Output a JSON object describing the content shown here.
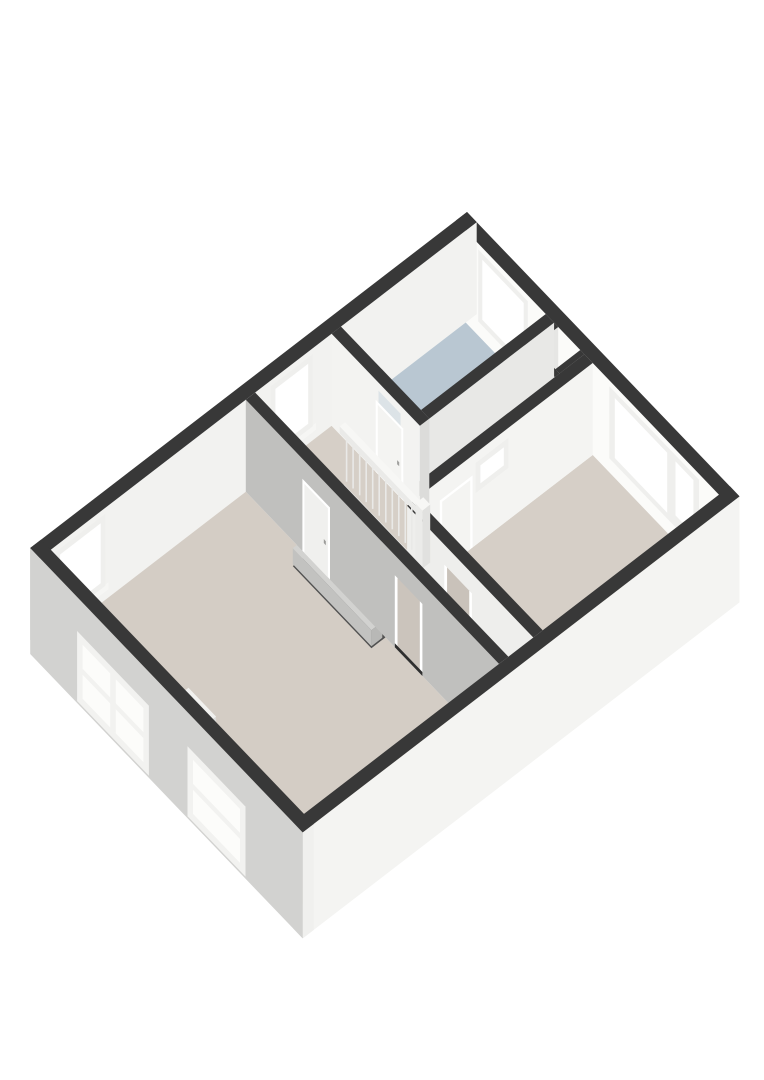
{
  "meta": {
    "description": "3D isometric floor plan render of an upper floor with landing, stairwell, bathroom and two bedrooms",
    "view": "axonometric"
  },
  "colors": {
    "wall_cut_top": "#383838",
    "wall_white": "#f4f4f2",
    "wall_gray": "#c0c0be",
    "facade_sw": "#d2d2d0",
    "facade_se": "#f4f4f2",
    "floor_beige": "#d6cfc7",
    "floor_bathroom": "#b9c7d2",
    "stair_void": "#515151",
    "threshold_dark": "#2f2f2f",
    "sink_wood": "#cdbfa8",
    "glass_white": "#ffffff",
    "transom_glass": "#dce3e7"
  },
  "rooms": [
    {
      "name": "bathroom",
      "floor_color": "#b9c7d2"
    },
    {
      "name": "landing-hall",
      "floor_color": "#d6cfc7"
    },
    {
      "name": "bedroom-right",
      "floor_color": "#d6cfc7"
    },
    {
      "name": "bedroom-left",
      "floor_color": "#d4cdc5"
    },
    {
      "name": "corridor-strip",
      "floor_color": "#d3ccc4"
    },
    {
      "name": "shaft-niche",
      "floor_color": "#7a7e80"
    }
  ],
  "scene": [
    {
      "t": "box",
      "name": "facade-ne-wall",
      "r": [
        0,
        0,
        395,
        14
      ],
      "z": [
        0,
        92
      ],
      "c": {
        "top": "#383838",
        "sw": "#fbfbf9",
        "se": "#efefed"
      }
    },
    {
      "t": "qsw",
      "name": "bathroom-window-frame",
      "v": 14,
      "u": [
        32,
        104
      ],
      "z": [
        14,
        86
      ],
      "fill": "#efefed"
    },
    {
      "t": "qsw",
      "name": "bathroom-window-glass",
      "v": 14,
      "u": [
        38,
        98
      ],
      "z": [
        20,
        80
      ],
      "fill": "#ffffff"
    },
    {
      "t": "qsw",
      "name": "bedroom-window-frame",
      "v": 14,
      "u": [
        222,
        352
      ],
      "z": [
        14,
        86
      ],
      "fill": "#efefed"
    },
    {
      "t": "qsw",
      "name": "bedroom-window-glass-large",
      "v": 14,
      "u": [
        230,
        306
      ],
      "z": [
        20,
        80
      ],
      "fill": "#ffffff"
    },
    {
      "t": "qsw",
      "name": "bedroom-window-glass-small",
      "v": 14,
      "u": [
        318,
        344
      ],
      "z": [
        26,
        80
      ],
      "fill": "#ffffff"
    },
    {
      "t": "box",
      "name": "facade-nw-wall",
      "r": [
        0,
        0,
        14,
        560
      ],
      "z": [
        0,
        92
      ],
      "c": {
        "top": "#383838",
        "sw": "#cfcfcd",
        "se": "#f2f2f0"
      }
    },
    {
      "t": "qse",
      "name": "landing-window-sill",
      "u": 14,
      "v": [
        206,
        268
      ],
      "z": [
        8,
        15
      ],
      "fill": "#f6f6f4"
    },
    {
      "t": "qse",
      "name": "landing-window-frame",
      "u": 14,
      "v": [
        210,
        264
      ],
      "z": [
        14,
        86
      ],
      "fill": "#efefed"
    },
    {
      "t": "qse",
      "name": "landing-window-glass",
      "u": 14,
      "v": [
        216,
        258
      ],
      "z": [
        20,
        80
      ],
      "fill": "#ffffff"
    },
    {
      "t": "qse",
      "name": "bedroom-left-nw-window-sill",
      "u": 14,
      "v": [
        472,
        544
      ],
      "z": [
        8,
        15
      ],
      "fill": "#f6f6f4"
    },
    {
      "t": "qse",
      "name": "bedroom-left-nw-window-frame",
      "u": 14,
      "v": [
        476,
        540
      ],
      "z": [
        14,
        86
      ],
      "fill": "#efefed"
    },
    {
      "t": "qse",
      "name": "bedroom-left-nw-window-glass",
      "u": 14,
      "v": [
        482,
        534
      ],
      "z": [
        20,
        80
      ],
      "fill": "#ffffff"
    },
    {
      "t": "floor",
      "name": "bathroom-floor",
      "r": [
        14,
        14,
        130,
        174
      ],
      "fill": "#b9c7d2"
    },
    {
      "t": "floor",
      "name": "corridor-floor",
      "r": [
        142,
        52,
        186,
        186
      ],
      "fill": "#d6cfc7"
    },
    {
      "t": "floor",
      "name": "landing-floor",
      "r": [
        14,
        186,
        186,
        284
      ],
      "fill": "#d6cfc7"
    },
    {
      "t": "floor",
      "name": "corridor-strip-floor",
      "r": [
        186,
        240,
        381,
        284
      ],
      "fill": "#d3ccc4"
    },
    {
      "t": "floor",
      "name": "bedroom-right-floor",
      "r": [
        198,
        14,
        381,
        240
      ],
      "fill": "#d6cfc7"
    },
    {
      "t": "floor",
      "name": "bedroom-left-floor",
      "r": [
        14,
        296,
        381,
        546
      ],
      "fill": "#d4cdc5"
    },
    {
      "t": "floor",
      "name": "shaft-niche-floor",
      "r": [
        148,
        14,
        180,
        46
      ],
      "fill": "#7a7e80"
    },
    {
      "t": "box",
      "name": "shaft-wall-nw",
      "r": [
        142,
        14,
        148,
        52
      ],
      "z": [
        0,
        92
      ],
      "c": {
        "top": "#383838",
        "sw": "#f0f0ee",
        "se": "#e6e6e4"
      }
    },
    {
      "t": "box",
      "name": "shaft-wall-se",
      "r": [
        180,
        14,
        186,
        46
      ],
      "z": [
        0,
        92
      ],
      "c": {
        "top": "#383838",
        "sw": "#f0f0ee",
        "se": "#e6e6e4"
      }
    },
    {
      "t": "box",
      "name": "shaft-wall-sw",
      "r": [
        142,
        46,
        186,
        52
      ],
      "z": [
        0,
        92
      ],
      "c": {
        "top": "#383838",
        "sw": "#f0f0ee",
        "se": "#e6e6e4"
      }
    },
    {
      "t": "box",
      "name": "bathroom-se-wall",
      "r": [
        130,
        14,
        142,
        174
      ],
      "z": [
        0,
        92
      ],
      "c": {
        "top": "#383838",
        "sw": "#e9e9e7",
        "se": "#e8e8e6"
      }
    },
    {
      "t": "box",
      "name": "sink-cabinet",
      "r": [
        24,
        146,
        64,
        172
      ],
      "z": [
        0,
        30
      ],
      "c": {
        "top": "#d8cab2",
        "sw": "#cdbfa8",
        "se": "#c2b49c"
      }
    },
    {
      "t": "box",
      "name": "sink-counter",
      "r": [
        20,
        142,
        68,
        176
      ],
      "z": [
        30,
        37
      ],
      "c": {
        "top": "#f7f7f5",
        "sw": "#ececea",
        "se": "#e2e2e0"
      }
    },
    {
      "t": "floor",
      "name": "sink-basin",
      "r": [
        26,
        148,
        58,
        170
      ],
      "z": 37.3,
      "fill": "#e8ecee"
    },
    {
      "t": "box",
      "name": "bedroom-right-nw-wall",
      "r": [
        186,
        14,
        198,
        240
      ],
      "z": [
        0,
        92
      ],
      "c": {
        "top": "#383838",
        "sw": "#e0e0de",
        "se": "#f4f4f2"
      }
    },
    {
      "t": "qse",
      "name": "bedroom-door-transom-frame",
      "u": 198,
      "v": [
        122,
        164
      ],
      "z": [
        52,
        82
      ],
      "fill": "#efefed"
    },
    {
      "t": "qse",
      "name": "bedroom-door-transom-glass",
      "u": 198,
      "v": [
        128,
        158
      ],
      "z": [
        58,
        76
      ],
      "fill": "#ffffff"
    },
    {
      "t": "qse",
      "name": "bedroom-door-frame",
      "u": 198,
      "v": [
        168,
        210
      ],
      "z": [
        0,
        72
      ],
      "fill": "#ffffff"
    },
    {
      "t": "qse",
      "name": "bedroom-door-leaf",
      "u": 198,
      "v": [
        171,
        207
      ],
      "z": [
        0,
        69
      ],
      "fill": "#f4f4f2"
    },
    {
      "t": "qse",
      "name": "bedroom-door-handle",
      "u": 198,
      "v": [
        201,
        204
      ],
      "z": [
        30,
        34
      ],
      "fill": "#a0a09e"
    },
    {
      "t": "box",
      "name": "bathroom-sw-wall",
      "r": [
        14,
        174,
        142,
        186
      ],
      "z": [
        0,
        92
      ],
      "c": {
        "top": "#383838",
        "sw": "#f3f3f1",
        "se": "#dcdcda"
      }
    },
    {
      "t": "qsw",
      "name": "bathroom-door-transom-glass",
      "v": 186,
      "u": [
        82,
        114
      ],
      "z": [
        72,
        84
      ],
      "fill": "#dce3e7"
    },
    {
      "t": "qsw",
      "name": "bathroom-door-frame",
      "v": 186,
      "u": [
        78,
        118
      ],
      "z": [
        0,
        72
      ],
      "fill": "#ffffff"
    },
    {
      "t": "qsw",
      "name": "bathroom-door-leaf",
      "v": 186,
      "u": [
        81,
        115
      ],
      "z": [
        0,
        69
      ],
      "fill": "#f4f4f2"
    },
    {
      "t": "qsw",
      "name": "bathroom-door-handle",
      "v": 186,
      "u": [
        109,
        112
      ],
      "z": [
        30,
        34
      ],
      "fill": "#a0a09e"
    },
    {
      "t": "box",
      "name": "bedroom-right-sw-wall",
      "r": [
        198,
        240,
        381,
        252
      ],
      "z": [
        0,
        92
      ],
      "c": {
        "top": "#383838",
        "sw": "#eeeeec",
        "se": "#e3e3e1"
      }
    },
    {
      "t": "qsw",
      "name": "strip-doorway-jamb-left",
      "v": 252,
      "u": [
        252,
        256
      ],
      "z": [
        0,
        72
      ],
      "fill": "#ffffff"
    },
    {
      "t": "qsw",
      "name": "strip-doorway-jamb-right",
      "v": 252,
      "u": [
        288,
        292
      ],
      "z": [
        0,
        72
      ],
      "fill": "#ffffff"
    },
    {
      "t": "qsw",
      "name": "strip-doorway-opening",
      "v": 252,
      "u": [
        256,
        288
      ],
      "z": [
        4,
        72
      ],
      "fill": "#c9c2ba"
    },
    {
      "t": "qsw",
      "name": "strip-doorway-threshold",
      "v": 252,
      "u": [
        252,
        292
      ],
      "z": [
        0,
        4
      ],
      "fill": "#2f2f2f"
    },
    {
      "t": "floor",
      "name": "stairwell-void",
      "r": [
        64,
        214,
        178,
        280
      ],
      "z": -48,
      "fill": "#515151"
    },
    {
      "t": "box",
      "name": "stair-step-1",
      "r": [
        64,
        214,
        178,
        232
      ],
      "z": [
        -22,
        -6
      ],
      "c": {
        "top": "#eaeae8",
        "sw": "#dadad8",
        "se": "#d0d0ce"
      }
    },
    {
      "t": "box",
      "name": "stair-step-2",
      "r": [
        64,
        232,
        178,
        249
      ],
      "z": [
        -30,
        -14
      ],
      "c": {
        "top": "#e2e2e0",
        "sw": "#d2d2d0",
        "se": "#c8c8c6"
      }
    },
    {
      "t": "box",
      "name": "stair-step-3",
      "r": [
        64,
        249,
        178,
        266
      ],
      "z": [
        -38,
        -22
      ],
      "c": {
        "top": "#dadad8",
        "sw": "#cacac8",
        "se": "#c0c0be"
      }
    },
    {
      "t": "box",
      "name": "stair-step-4",
      "r": [
        64,
        266,
        178,
        280
      ],
      "z": [
        -46,
        -30
      ],
      "c": {
        "top": "#d2d2d0",
        "sw": "#c2c2c0",
        "se": "#b8b8b6"
      }
    },
    {
      "t": "box",
      "name": "stair-stringer",
      "r": [
        64,
        278,
        180,
        286
      ],
      "z": [
        0,
        10
      ],
      "c": {
        "top": "#f2f2f0",
        "sw": "#e6e6e4",
        "se": "#dcdcda"
      }
    },
    {
      "t": "rail",
      "name": "stair-balustrade-spindles",
      "v": 214.5,
      "u": [
        68,
        172
      ],
      "z": [
        0,
        46
      ],
      "n": 12,
      "stroke": "#e9e9e7"
    },
    {
      "t": "box",
      "name": "stair-handrail",
      "r": [
        62,
        211,
        182,
        218
      ],
      "z": [
        46,
        53
      ],
      "c": {
        "top": "#f7f7f5",
        "sw": "#eaeae8",
        "se": "#e0e0de"
      }
    },
    {
      "t": "box",
      "name": "stair-newel-post",
      "r": [
        174,
        210,
        184,
        220
      ],
      "z": [
        0,
        58
      ],
      "c": {
        "top": "#f7f7f5",
        "sw": "#ebebe9",
        "se": "#e1e1df"
      }
    },
    {
      "t": "box",
      "name": "bedroom-left-ne-wall",
      "r": [
        14,
        284,
        381,
        296
      ],
      "z": [
        0,
        92
      ],
      "c": {
        "top": "#383838",
        "sw": "#c0c0be",
        "se": "#d8d8d6"
      }
    },
    {
      "t": "qsw",
      "name": "bedroom-left-door-frame",
      "v": 296,
      "u": [
        96,
        136
      ],
      "z": [
        0,
        72
      ],
      "fill": "#ffffff"
    },
    {
      "t": "qsw",
      "name": "bedroom-left-door-leaf",
      "v": 296,
      "u": [
        99,
        133
      ],
      "z": [
        0,
        69
      ],
      "fill": "#f0f0ee"
    },
    {
      "t": "qsw",
      "name": "bedroom-left-door-handle",
      "v": 296,
      "u": [
        127,
        130
      ],
      "z": [
        30,
        34
      ],
      "fill": "#9a9a98"
    },
    {
      "t": "qsw",
      "name": "hall-doorway-jamb-left",
      "v": 296,
      "u": [
        230,
        234
      ],
      "z": [
        0,
        72
      ],
      "fill": "#ffffff"
    },
    {
      "t": "qsw",
      "name": "hall-doorway-jamb-right",
      "v": 296,
      "u": [
        266,
        270
      ],
      "z": [
        0,
        72
      ],
      "fill": "#ffffff"
    },
    {
      "t": "qsw",
      "name": "hall-doorway-opening",
      "v": 296,
      "u": [
        234,
        266
      ],
      "z": [
        4,
        72
      ],
      "fill": "#cbc4bc"
    },
    {
      "t": "qsw",
      "name": "hall-doorway-threshold",
      "v": 296,
      "u": [
        230,
        270
      ],
      "z": [
        0,
        4
      ],
      "fill": "#2f2f2f"
    },
    {
      "t": "box",
      "name": "chimney-breast",
      "r": [
        182,
        518,
        222,
        546
      ],
      "z": [
        0,
        58
      ],
      "c": {
        "top": "#f1f1ef",
        "sw": "#e7e7e5",
        "se": "#dcdcda"
      }
    },
    {
      "t": "box",
      "name": "facade-se-wall",
      "r": [
        381,
        0,
        395,
        560
      ],
      "z": [
        -14,
        92
      ],
      "c": {
        "top": "#383838",
        "sw": "#cfcfcd",
        "se": "#f4f4f2"
      }
    },
    {
      "t": "box",
      "name": "facade-sw-wall",
      "r": [
        0,
        546,
        395,
        560
      ],
      "z": [
        -14,
        92
      ],
      "c": {
        "top": "#383838",
        "sw": "#d2d2d0",
        "se": "#f0f0ee"
      }
    },
    {
      "t": "qsw",
      "name": "sw-window-a-frame",
      "v": 560,
      "u": [
        68,
        172
      ],
      "z": [
        -12,
        58
      ],
      "fill": "#f2f2f0"
    },
    {
      "t": "qsw",
      "name": "sw-window-a-glass",
      "v": 560,
      "u": [
        76,
        164
      ],
      "z": [
        -4,
        50
      ],
      "fill": "#fcfcfa"
    },
    {
      "t": "qsw",
      "name": "sw-window-a-mullion-v",
      "v": 560,
      "u": [
        116,
        124
      ],
      "z": [
        -4,
        50
      ],
      "fill": "#f2f2f0"
    },
    {
      "t": "qsw",
      "name": "sw-window-a-mullion-h",
      "v": 560,
      "u": [
        76,
        164
      ],
      "z": [
        20,
        26
      ],
      "fill": "#f2f2f0"
    },
    {
      "t": "qsw",
      "name": "sw-window-b-frame",
      "v": 560,
      "u": [
        228,
        312
      ],
      "z": [
        -12,
        58
      ],
      "fill": "#f2f2f0"
    },
    {
      "t": "qsw",
      "name": "sw-window-b-glass",
      "v": 560,
      "u": [
        236,
        304
      ],
      "z": [
        -4,
        50
      ],
      "fill": "#fcfcfa"
    },
    {
      "t": "qsw",
      "name": "sw-window-b-mullion-h",
      "v": 560,
      "u": [
        236,
        304
      ],
      "z": [
        20,
        26
      ],
      "fill": "#f2f2f0"
    }
  ]
}
